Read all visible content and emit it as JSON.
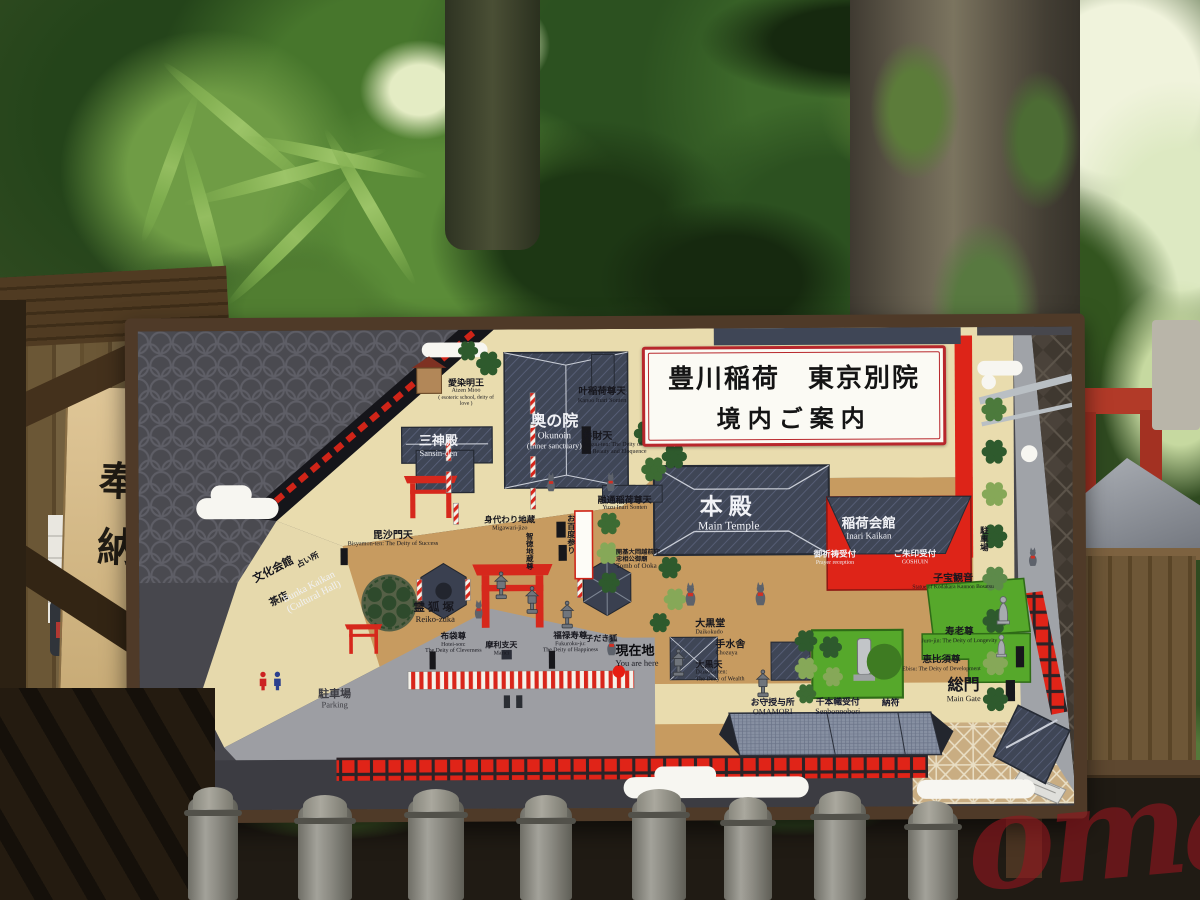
{
  "scene": {
    "watermark": "omairi",
    "wooden_sign": "奉納"
  },
  "board": {
    "title": {
      "line1": "豊川稲荷　東京別院",
      "line2": "境内ご案内"
    },
    "colors": {
      "accent_red": "#dd2418",
      "cream": "#e9dcae",
      "tan": "#c79b60",
      "green": "#56a82b",
      "roof_navy": "#3f4656"
    },
    "labels": {
      "aizen": {
        "jp": "愛染明王",
        "en": "Aizen Mioo",
        "en2": "( esoteric school, deity of love )"
      },
      "sansinden": {
        "jp": "三神殿",
        "en": "Sansin-den"
      },
      "okunoin": {
        "jp": "奥の院",
        "en": "Okunoin",
        "en2": "(Inner sanctuary)"
      },
      "kanoo": {
        "jp": "叶稲荷尊天",
        "en": "Kanoo Inari Sonten"
      },
      "benzaiten": {
        "jp": "弁財天",
        "en": "Benzai-ten: The Deity of Music and Beauty and Eloquence"
      },
      "yuzu": {
        "jp": "融通稲荷尊天",
        "en": "Yuzu Inari Sonten"
      },
      "migawari": {
        "jp": "身代わり地蔵",
        "en": "Migawari-jizo"
      },
      "chitoku": {
        "jp": "智徳地蔵尊"
      },
      "ohyakudo": {
        "jp": "お百度参り"
      },
      "bisyamon": {
        "jp": "毘沙門天",
        "en": "Bisyamon-ten: The Deity of Success"
      },
      "honden": {
        "jp": "本殿",
        "en": "Main Temple"
      },
      "inari_kaikan": {
        "jp": "稲荷会館",
        "en": "Inari Kaikan"
      },
      "prayer": {
        "jp": "御祈祷受付",
        "en": "Prayer reception"
      },
      "goshuin": {
        "jp": "ご朱印受付",
        "en": "GOSHUIN"
      },
      "ooka": {
        "jp": "開基大岡越前守\n忠相公御廟",
        "en": "Tomb of Ooka"
      },
      "reikozuka": {
        "jp": "霊狐塚",
        "en": "Reiko-zuka"
      },
      "bunka": {
        "jp": "文化会館",
        "jp2": "茶店",
        "en": "Bunka Kaikan\n(Cultural Hall)"
      },
      "uranai": {
        "jp": "占い所"
      },
      "parking_left": {
        "jp": "駐車場",
        "en": "Parking"
      },
      "parking_right": {
        "jp": "駐車場"
      },
      "hotei": {
        "jp": "布袋尊",
        "en": "Hotei-son:\nThe Deity of Cleverness"
      },
      "marici": {
        "jp": "摩利支天",
        "en": "Marici"
      },
      "fukuroku": {
        "jp": "福禄寿尊",
        "en": "Fukuroku-ju:\nThe Deity of Happiness"
      },
      "kodaki": {
        "jp": "子だき狐"
      },
      "you_are_here": {
        "jp": "現在地",
        "en": "You are here"
      },
      "daikokudo": {
        "jp": "大黒堂",
        "en": "Daikokudo"
      },
      "chozuya": {
        "jp": "手水舎",
        "en": "Chozuya"
      },
      "daikokuten": {
        "jp": "大黒天",
        "en": "Daikoku-ten:\nThe Deity of Wealth"
      },
      "kodakara": {
        "jp": "子宝観音",
        "en": "Statue of Kodakara Kannon Bosatsu"
      },
      "jurojin": {
        "jp": "寿老尊",
        "en": "Juro-jin: The Deity of Longevity"
      },
      "ebisu": {
        "jp": "恵比須尊",
        "en": "Ebisu: The Deity of Development"
      },
      "somon": {
        "jp": "総門",
        "en": "Main Gate"
      },
      "omamori": {
        "jp": "お守授与所",
        "en": "OMAMORI"
      },
      "senbon": {
        "jp": "千本幟受付",
        "en": "Senbonnobori"
      },
      "nofu": {
        "jp": "納符"
      }
    }
  }
}
